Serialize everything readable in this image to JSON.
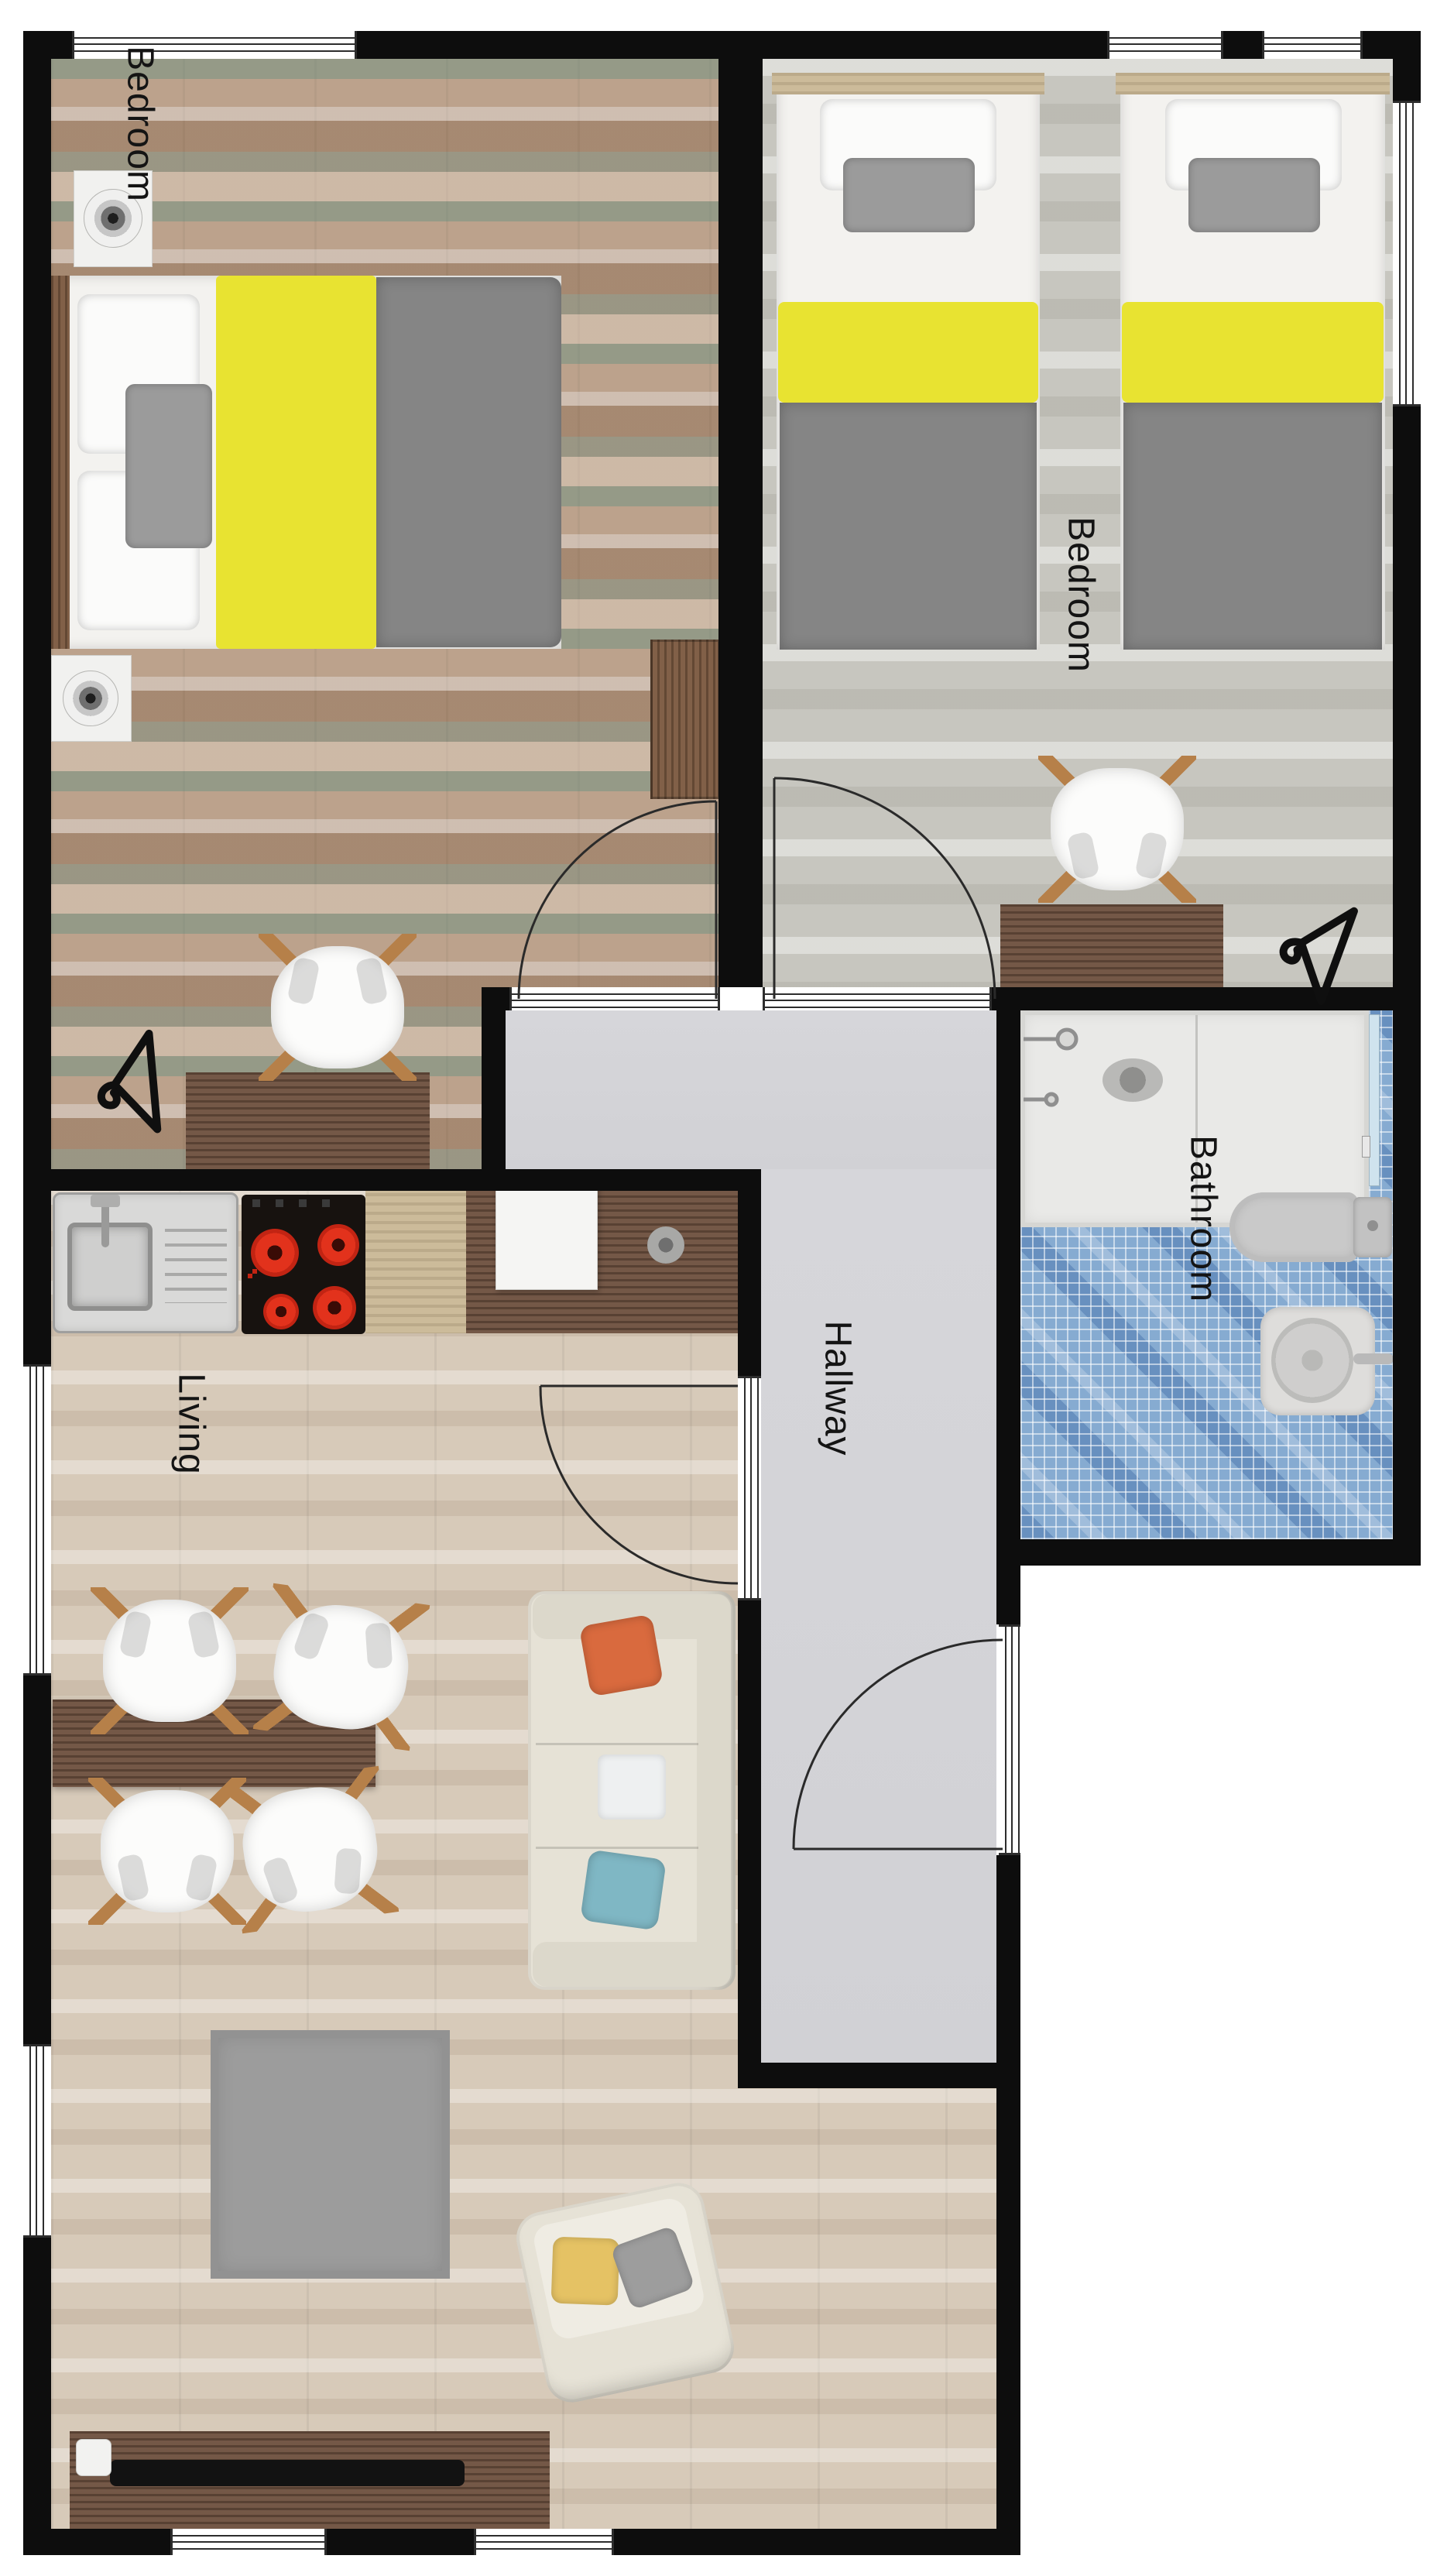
{
  "plan_title": "Apartment floor plan",
  "rooms": [
    {
      "name": "bedroom-1",
      "label": "Bedroom"
    },
    {
      "name": "bedroom-2",
      "label": "Bedroom"
    },
    {
      "name": "bathroom",
      "label": "Bathroom"
    },
    {
      "name": "hallway",
      "label": "Hallway"
    },
    {
      "name": "living",
      "label": "Living"
    }
  ],
  "palette": {
    "wall": "#0d0d0d",
    "bed_accent_yellow": "#e8e331",
    "blanket_gray": "#858585",
    "bathroom_tile_blue": "#86abd1",
    "hallway_floor": "#d4d4d8",
    "living_floor": "#d7cab9",
    "bedroom1_floor": "#b29781",
    "bedroom2_floor": "#c7c6bf",
    "pillow_orange": "#d96a3e",
    "pillow_teal": "#7fb7c4",
    "pillow_yellow": "#e5c264",
    "burner_red": "#e2321c",
    "wood_dark": "#6e5140"
  },
  "furniture": {
    "bedroom_1": [
      "double-bed",
      "nightstand-lamp",
      "nightstand-lamp",
      "wardrobe",
      "desk",
      "chair",
      "clothes-hanger"
    ],
    "bedroom_2": [
      "twin-bed",
      "twin-bed",
      "desk",
      "chair",
      "clothes-hanger"
    ],
    "bathroom": [
      "shower",
      "toilet",
      "washbasin"
    ],
    "living": [
      "kitchen-sink",
      "cooktop",
      "counter",
      "dining-table",
      "chair",
      "chair",
      "chair",
      "chair",
      "sofa",
      "rug",
      "armchair",
      "tv-stand"
    ]
  },
  "doors": [
    "bedroom-1-door",
    "bedroom-2-door",
    "living-door",
    "entry-door"
  ],
  "windows_count": 8
}
